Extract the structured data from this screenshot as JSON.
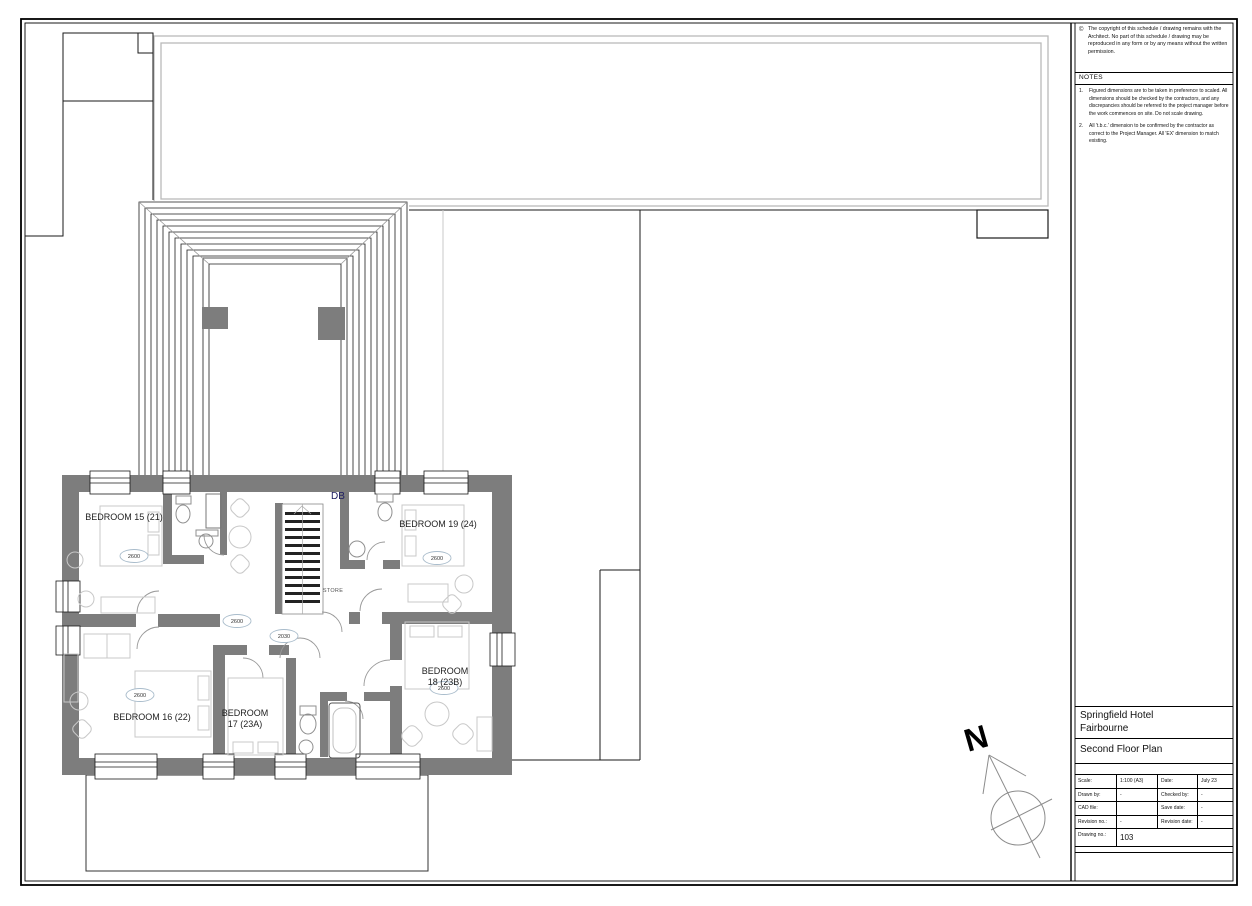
{
  "sheet": {
    "copyright_symbol": "©",
    "copyright": "The copyright of this schedule / drawing remains with the Architect. No part of this schedule / drawing may be reproduced in any form or by any means without the written permission.",
    "notes_title": "NOTES",
    "notes": [
      {
        "num": "1.",
        "text": "Figured dimensions are to be taken in preference to scaled. All dimensions should be checked by the contractors, and any discrepancies should be referred to the project manager before the work commences on site. Do not scale drawing."
      },
      {
        "num": "2.",
        "text": "All 't.b.c.' dimension to be confirmed by the contractor as correct to the Project Manager. All 'EX' dimension to match existing."
      }
    ],
    "project_line1": "Springfield Hotel",
    "project_line2": "Fairbourne",
    "drawing_title": "Second Floor Plan",
    "info": {
      "scale_label": "Scale:",
      "scale_value": "1:100 (A3)",
      "date_label": "Date:",
      "date_value": "July 23",
      "drawn_label": "Drawn by:",
      "drawn_value": "-",
      "checked_label": "Checked by:",
      "checked_value": "-",
      "cad_label": "CAD file:",
      "cad_value": "",
      "save_label": "Save date:",
      "save_value": "-",
      "revno_label": "Revision no.:",
      "revno_value": "-",
      "revdate_label": "Revision date:",
      "revdate_value": "-",
      "dwgno_label": "Drawing no.:",
      "dwgno_value": "103"
    }
  },
  "plan": {
    "rooms": {
      "b15": {
        "label": "BEDROOM 15 (21)",
        "dim": "2600"
      },
      "b16": {
        "label": "BEDROOM 16 (22)",
        "dim": "2600"
      },
      "b17": {
        "line1": "BEDROOM",
        "line2": "17 (23A)"
      },
      "b18": {
        "line1": "BEDROOM",
        "line2": "18 (23B)",
        "dim": "2600"
      },
      "b19": {
        "label": "BEDROOM 19 (24)",
        "dim": "2600"
      }
    },
    "labels": {
      "db": "DB",
      "store": "STORE"
    },
    "dims": {
      "corridor": "2600",
      "landing": "2030"
    },
    "north": "N"
  },
  "colors": {
    "wall": "#7d7d7d",
    "furniture": "#c8c8c8",
    "roof_outline": "#b9b9b9"
  }
}
